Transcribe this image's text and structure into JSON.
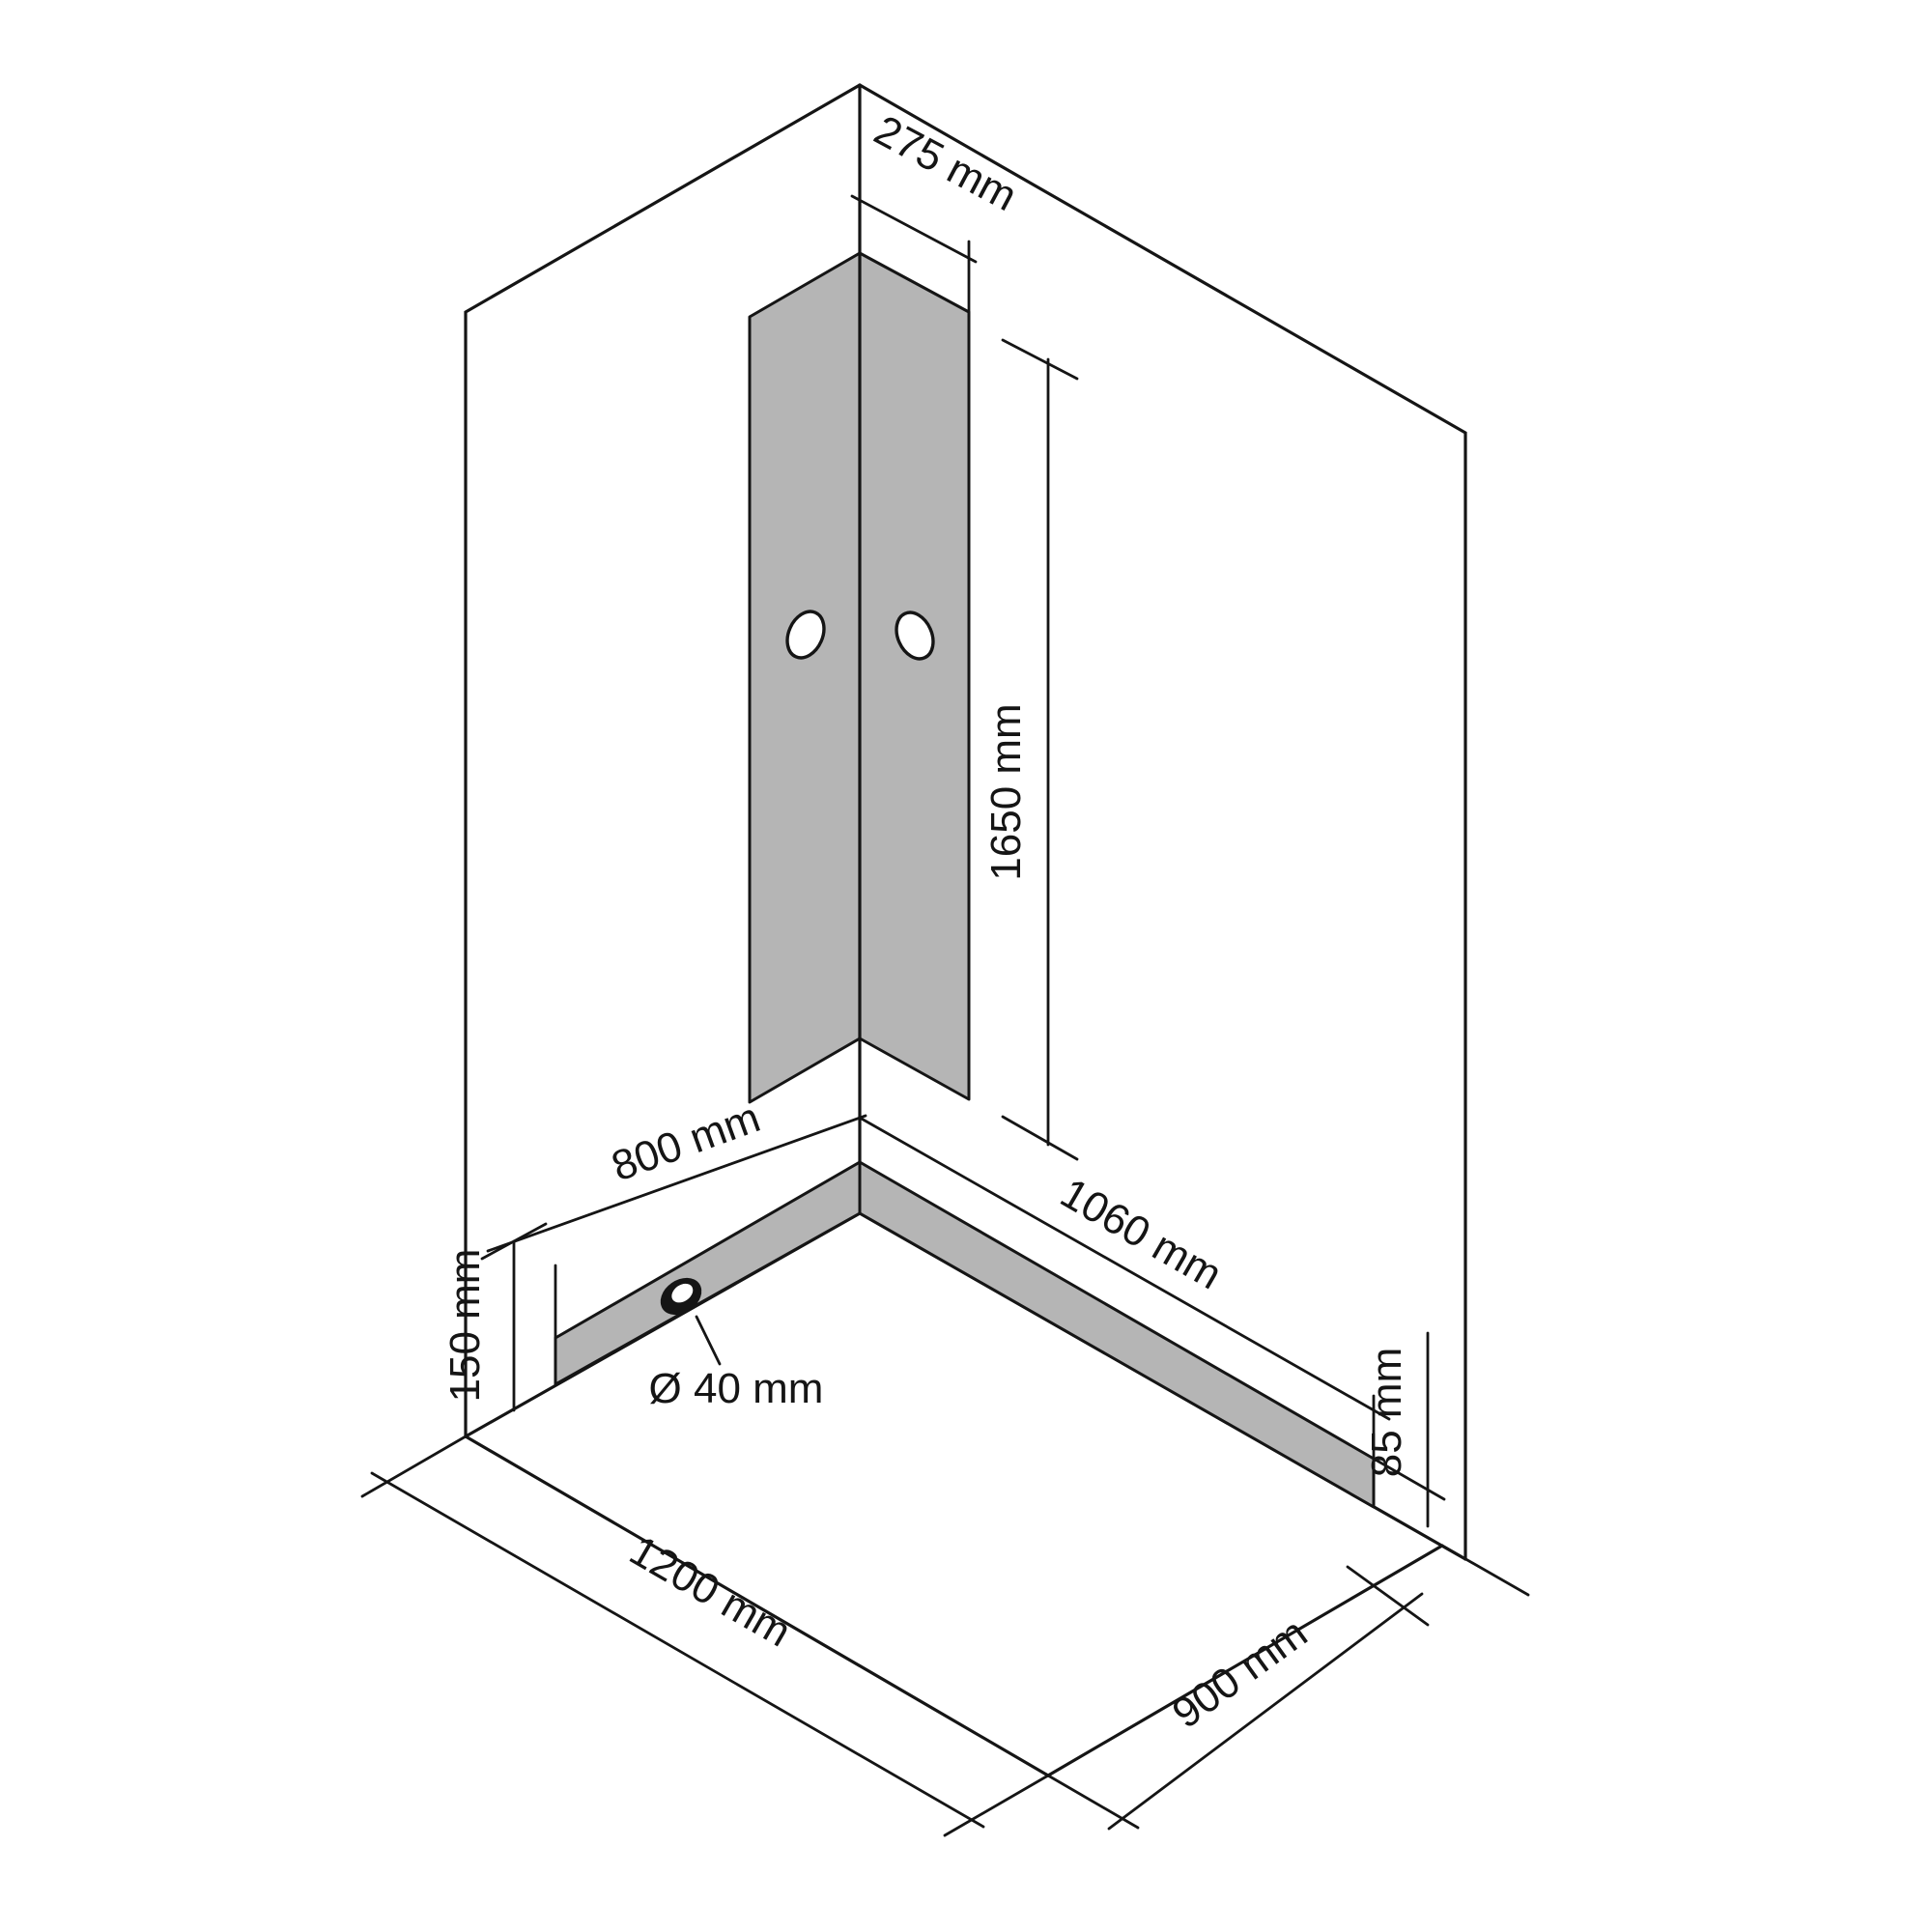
{
  "diagram": {
    "type": "isometric-installation-drawing",
    "subject": "corner shower cabin wall and tray mounting dimensions",
    "unit": "mm",
    "labels": {
      "panel_width": "275 mm",
      "panel_height": "1650 mm",
      "left_strip_length": "800 mm",
      "left_strip_height": "150 mm",
      "drain_diameter": "Ø 40 mm",
      "right_strip_length": "1060 mm",
      "right_strip_height": "85 mm",
      "tray_length": "1200 mm",
      "tray_depth": "900 mm"
    },
    "dimensions_mm": {
      "connection_panel_width": 275,
      "connection_panel_height": 1650,
      "left_wall_strip_length": 800,
      "left_wall_strip_height": 150,
      "drain_hole_diameter": 40,
      "right_wall_strip_length": 1060,
      "right_wall_strip_height": 85,
      "floor_tray_length": 1200,
      "floor_tray_depth": 900
    },
    "colors": {
      "line": "#151515",
      "zone_fill": "#b5b5b5",
      "background": "#ffffff"
    }
  }
}
